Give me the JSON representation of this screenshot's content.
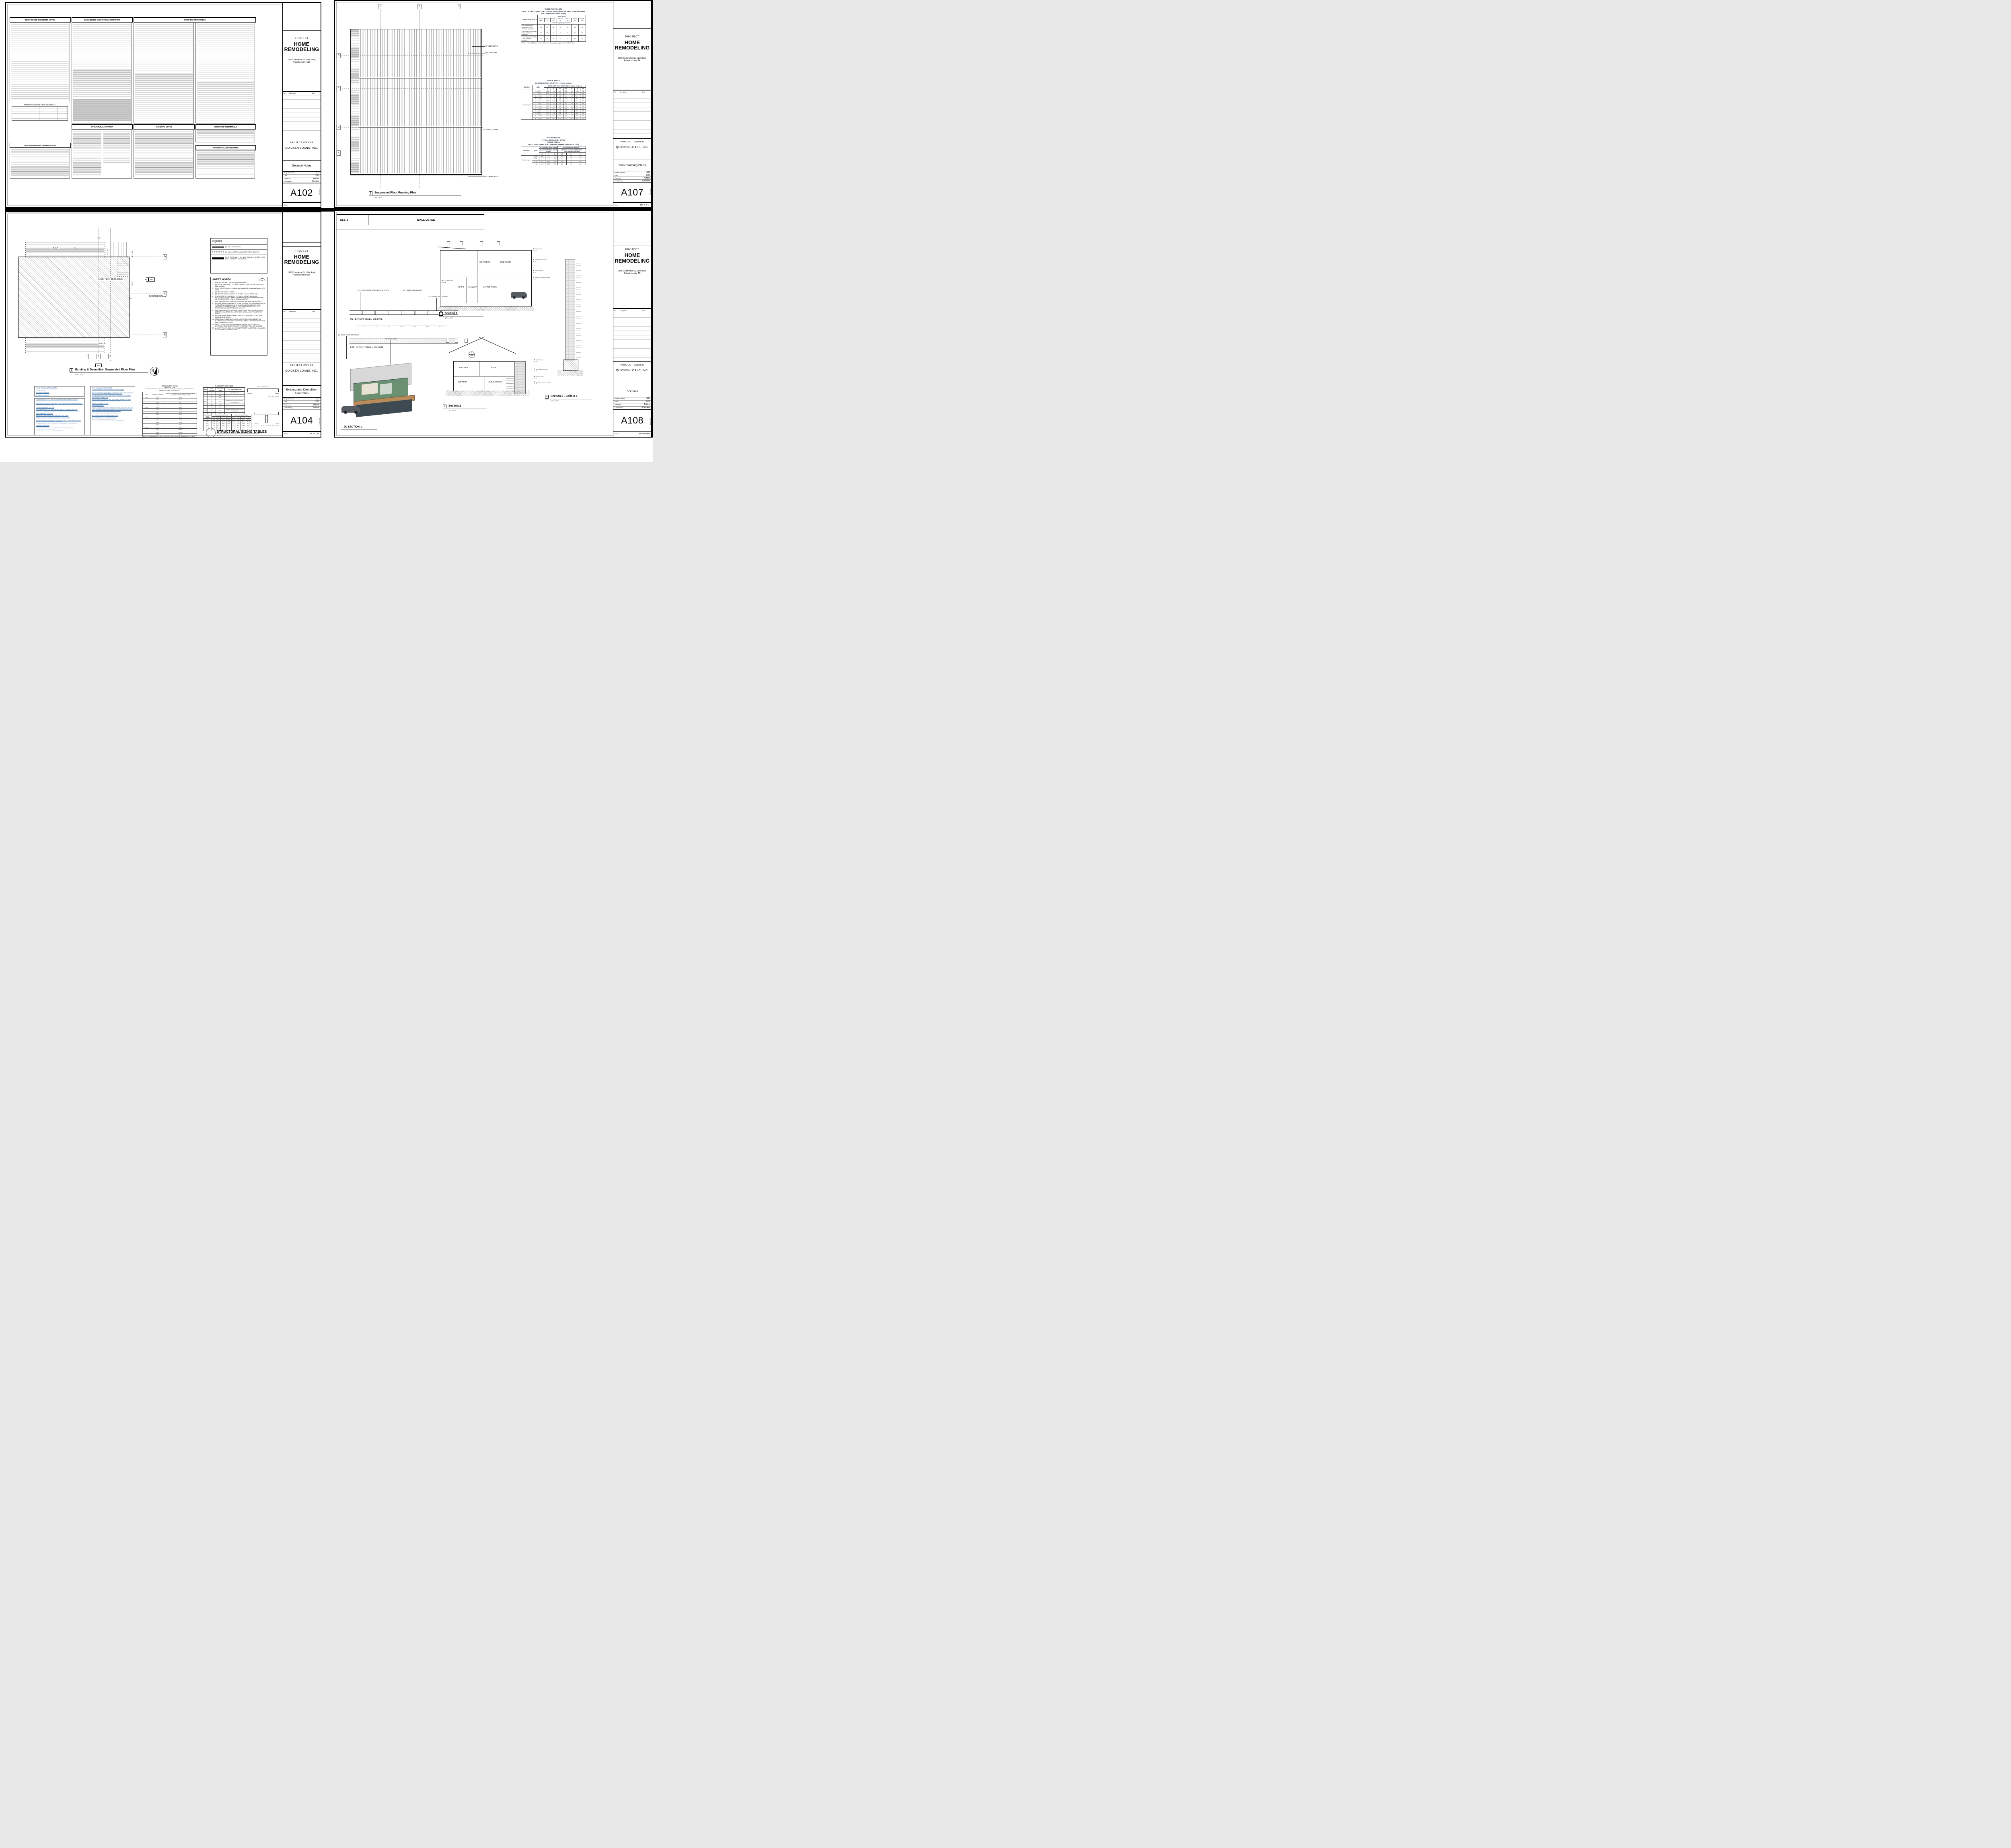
{
  "project": {
    "label": "PROJECT",
    "name": "HOME REMODELING",
    "address": "1506 Commerce St, Little Rock, Pulaski county, AR",
    "owner_label": "PROJECT OWNER",
    "owner": "QUICKEN LOANS, INC.",
    "number": "003",
    "date": "2/22",
    "drawn_by": "Author",
    "checked_by": "Checker",
    "labels": {
      "project_number": "Project number",
      "date": "Date",
      "drawn_by": "Drawn by",
      "checked_by": "Checked by",
      "scale": "Scale"
    },
    "revision": {
      "no": "No.",
      "description": "Description",
      "date": "Date"
    },
    "plot_stamp": "2:48:23 AM"
  },
  "sheets": {
    "a102": {
      "number": "A102",
      "title": "General Notes",
      "scale": "",
      "headers": {
        "col1": "REINFORCED CONCRETE NOTES",
        "col2": "ENGINEERED WOOD TRUSSES/RAFTER",
        "col3": "WOOD FRAMING NOTES",
        "structural": "STRUCTURAL CRITERIA",
        "general": "GENERAL NOTES",
        "deferred": "DEFERRED SUBMITTALS",
        "site": "SITE DRAINAGE RECOMMENDATIONS",
        "anchors": "POST INSTALLED ANCHORS",
        "lap_schedule": "REINFORCED CONCRETE LAP SPLICE SCHEDULE"
      }
    },
    "a107": {
      "number": "A107",
      "title": "Floor Framing Plans",
      "scale": "3/8\" = 1'-0\"",
      "plan": {
        "viewport_no": "1",
        "title": "Suspended Floor Framing Plan",
        "scale": "3/8\" = 1'-0\"",
        "ann_blocking": "2 X 6 BLOCKING",
        "ann_beams": "(2) 2 x 6 BEAMS",
        "ann_joists": "2 x 6 DECK JOISTS",
        "ann_rim": "2 x 6 RIM JOIST",
        "grid_cols": [
          "1",
          "2",
          "3"
        ],
        "grid_rows": [
          "D",
          "C",
          "B",
          "A"
        ]
      },
      "table1": {
        "title1": "TABLE R507.9.1.3(1)",
        "title2": "DECK LEDGER CONNECTION TO BAND JOISTᵃ, ᵇ(Deck live load = 40 psf, deck dead load = 10 psf, snow load ≤ 40 psf)",
        "row_label_header": "CONNECTION DETAILS",
        "col_group": "JOIST SPAN",
        "spans": [
          "6' and less",
          "6'1\" to 8'",
          "8'1\" to 10'",
          "10'1\" to 12'",
          "12'1\" to 14'",
          "14'1\" to 16'",
          "16'1\" to 18'"
        ],
        "subheader": "On-center spacing of fasteners",
        "rows": [
          [
            "½-inch diameter lag screw with ½-inch maximum sheathingᶜ, ᵈ",
            "30",
            "23",
            "18",
            "15",
            "13",
            "11",
            "10"
          ],
          [
            "½-inch diameter bolt with ½-inch maximum sheathingᵈ",
            "36",
            "36",
            "34",
            "29",
            "24",
            "21",
            "19"
          ],
          [
            "½-inch diameter bolt with 1-inch maximum sheathingᵉ",
            "36",
            "36",
            "29",
            "24",
            "21",
            "18",
            "16"
          ]
        ],
        "note": "For SI: 1 inch = 25.4 mm, 1 foot = 304.8 mm, 1 pound per square foot = 0.0479 kPa."
      },
      "table2": {
        "title1": "TABLE R507.5",
        "title2": "DECK BEAM SPAN LENGTHSᵃ, ᵇ, ᵍ (feet - inches)",
        "species_header": "SPECIESᶜ",
        "size_header": "SIZEᵈ",
        "col_group": "DECK JOIST SPAN LESS THAN OR EQUAL TO: (feet)",
        "spans": [
          "6",
          "8",
          "10",
          "12",
          "14",
          "16",
          "18"
        ],
        "species": "Southern pine",
        "rows": [
          [
            "1 — 2 × 6",
            "4-11",
            "4-0",
            "3-7",
            "3-3",
            "3-0",
            "2-10",
            "2-8"
          ],
          [
            "1 — 2 × 8",
            "5-11",
            "5-1",
            "4-7",
            "4-2",
            "2-10",
            "3-7",
            "3-5"
          ],
          [
            "1 — 2 × 10",
            "7-0",
            "6-0",
            "5-5",
            "4-11",
            "4-7",
            "4-3",
            "4-0"
          ],
          [
            "1 — 2 × 12",
            "8-3",
            "7-1",
            "6-4",
            "5-10",
            "5-5",
            "5-0",
            "4-9"
          ],
          [
            "2 — 2 × 6",
            "6-11",
            "5-11",
            "5-4",
            "4-10",
            "4-6",
            "4-3",
            "4-0"
          ],
          [
            "2 — 2 × 8",
            "8-9",
            "7-7",
            "6-9",
            "6-2",
            "5-9",
            "5-4",
            "5-0"
          ],
          [
            "2 — 2 × 10",
            "10-4",
            "9-0",
            "8-0",
            "7-4",
            "6-9",
            "6-4",
            "6-0"
          ],
          [
            "2 — 2 × 12",
            "12-2",
            "10-7",
            "9-5",
            "8-7",
            "8-0",
            "7-6",
            "7-0"
          ],
          [
            "3 — 2 × 6",
            "8-2",
            "7-5",
            "6-8",
            "6-1",
            "5-8",
            "5-3",
            "5-0"
          ],
          [
            "3 — 2 × 8",
            "10-10",
            "9-6",
            "8-6",
            "7-9",
            "7-2",
            "6-8",
            "6-4"
          ],
          [
            "3 — 2 × 10",
            "13-0",
            "11-3",
            "10-0",
            "9-2",
            "8-6",
            "7-11",
            "7-6"
          ],
          [
            "3 — 2 × 12",
            "15-3",
            "13-3",
            "11-10",
            "10-9",
            "10-0",
            "9-4",
            "8-10"
          ]
        ]
      },
      "table3": {
        "title1": "FIGURE R507.6",
        "title2": "TYPICAL DECK JOIST SPANS",
        "title3": "TABLE R507.6",
        "title4": "DECK JOIST SPANS FOR COMMON LUMBER SPECIES (ft. - in.)",
        "species_header": "SPECIESᵃ",
        "size_header": "SIZE",
        "group1": "ALLOWABLE JOIST SPANᵇ",
        "group1_sub": "SPACING OF DECK JOISTS (inches)",
        "group2": "MAXIMUM CANTILEVERᶜ, ᶠ",
        "group2_sub": "SPACING OF DECK JOISTS WITH CANTILEVERSᶜ (inches)",
        "spacings": [
          "12",
          "16",
          "24",
          "12",
          "16",
          "24"
        ],
        "species": "Southern pine",
        "rows": [
          [
            "2 × 6",
            "9-11",
            "9-0",
            "7-7",
            "1-3",
            "1-4",
            "1-6"
          ],
          [
            "2 × 8",
            "13-1",
            "11-10",
            "9-8",
            "2-1",
            "2-3",
            "2-5"
          ],
          [
            "2 × 10",
            "16-2",
            "14-0",
            "11-5",
            "3-4",
            "3-6",
            "2-10"
          ],
          [
            "2 × 12",
            "18-0",
            "16-6",
            "13-6",
            "4-6",
            "4-2",
            "3-4"
          ]
        ]
      }
    },
    "a104": {
      "number": "A104",
      "title": "Existing and Demolition Floor Plan",
      "scale": "1/4\" = 1'-0\"",
      "legend": {
        "title": "legend",
        "items": [
          {
            "label": "(E) WALL TO REMAIN"
          },
          {
            "label": "(E) WALL, DOORS AND WINDOWS TO REMOVE"
          },
          {
            "label": "(N) 2x STUD WALL - ALL NEW WALLS TO RECEIVE 2X6 WITH R-13 BATT. INSULATION"
          }
        ]
      },
      "sheet_notes": {
        "title": "SHEET NOTES",
        "badge": "##",
        "items": [
          "REMOVE THIS WALL OPENING (SHOWN DASHED).",
          "(N) 4x10 HEADER WITH 2 -2x CRIPPLE WOOD STUDS AT EACH END OF THE NEW HEADER.",
          "(N) LG - 24k BTU Cooling + Heating - Wall Mounted Air Conditioning System - 17.0 SEER",
          "(N) PROVIDE WATER HEATER",
          "(N) PROVIDE WATER CLOSETS TO BE MAX. 1.28 GAL. PER FLUSH.",
          "SHOWER/TUB W/ FULL HEIGHT TILE WALLS & TEMPERED GLASS ENCLOSURE. USE BITUTHANE 4,000 WATERPROOFING MEMBRANE OVER 1/2\" WONDER BOARD & WALLS, CEILING, & FLOOR.",
          "NEW SOLID SURFACE (NON-SLIP RESISTANT) SHOWER PAN AND WALLS.",
          "PROVIDE SHOWER FINISHED TO 72\" ABOVE DRAIN. PROVIDE PRESSURE OR THERMOSTATIC MIXING VALUE @ SHOWER AND JACUZZI/TUB, WHICH LIMITS WATER TEMPERATURE TO 120°F. SHOWER HEAD SHALL NOT EXCEED 1.8 GALLONS PER MINUTE AT 60 PSI.",
          "NEW SINK AND FAUCET. PROVIDE FAUCET TO BE MAX 1.2 CMP AT 60 PSI. METERING FAUCETS SHALL NOT EXCEED 0.2 GALLONS PER METERING CYCLE.",
          "PROVIDE WATER HAMMER ARRESTORS AT ALL APPLIANCES THAT HAVE QUICK-ACTING VALVES",
          "REMOVE ALL PLUMBING FIXTURES, ACCESSORIES, AND CABINET. CAP PLUMBING LINS TEMPORARY FOR NEW PLUMBING LINES TEMPORARY FOR NEW PLUMBING FIXTURES.",
          "SAFETY GLASS TO BE USED WITHIN 3ft OF DOOR ENTRY LOCKS, AT ENNTRANCE DOORS AND SIDELIGHTS, NEAR BATHTUBS AND JACUZZIS.",
          "ALL SOFFITS LESS THAN 3.94 ft FROM PROPERTY LINES TO BE NON-VENTED SOLID MATERIAL CONSTRUCTION"
        ]
      },
      "plan": {
        "viewport_no": "1",
        "title": "Existing & Demolition Suspended Floor Plan",
        "scale": "1/4\" = 1'-0\"",
        "deck_top": "DECK",
        "deck_bottom": "DECK",
        "building": "EXISTING BUILDING",
        "walls": "EXISTING WALLS",
        "dn": "DN",
        "north": "N",
        "grid_cols": [
          "1",
          "2",
          "3"
        ],
        "grid_rows": [
          "D",
          "C",
          "B"
        ],
        "dim1": "7' - 4\"",
        "dim2": "6' - 6 1/2\"",
        "dim3": "12' - 2 1/2\"",
        "dim4": "30' - 6\"",
        "callout": {
          "no": "4",
          "sheet": "A109"
        },
        "section_marker": {
          "no": "1",
          "sheet": "A110"
        }
      },
      "floor_notes_header": {
        "title": "FLOOR FRAMING & TRUSS NOTES:",
        "items": [
          "FLOOR: 30 PSF LL",
          "10 PSF TOP CHORD DL",
          "5 PSF BOT. CHORD DL"
        ]
      },
      "floor_notes": [
        "FLOORS 3 AND 2 SHALL HAVE 22\" FLOOR TRUSSES; BOTTOM FLOOR IS CONCRETE SLAB.",
        "SUB-FLOOR SHEATHING SHALL BE H 1.125\". SHEATHING IS REQUIRED FOR ANY LONGITUDINAL(DRAG) FORCES.",
        "TRUSSES SPACED AT 24.0\" O/C.",
        "TRUSS DRAWING IS FOR ILLUSTRATION ONLY. ALL TRUSSES SHALL BE INSTALLED & BRACED TO MANUFACTURERS DRAWINGS & SPECIFICATIONS.",
        "ALL PLATES ARE 1.5 X 4 UNO",
        "DEFLECTION MEETS L/480 LIVE AND L/360 TOTAL LOAD.",
        "FASTEN RATED SHEATHING TO ONE FACE OF THIS FRAME.",
        "ALL TRUSSES WILL NOT BE FIELD ALTERED WITHOUT PRIOR BUILDING DEPT. APPROVAL OF ENGINEERING CALCULATIONS.",
        "ALL TRUSSES SHALL HAVE DESIGN DETAILS & DRAWINGS ON SITE FOR FRAMING INSPECTION.",
        "ALL FLOOR TRUSSES SHALL CARRY MANUFACTURERS STAMP.",
        "FLOOR TRUSS MANUFACTURER: ___________"
      ],
      "roof_notes_title": "ROOF FRAMING / TRUSS NOTES:",
      "roof_notes": [
        "ALL TRUSSES SHALL CARRY MANUFACTURERS STAMP.",
        "ALL TRUSSES WILL NOT BE FIELD ALTERED WITHOUT PRIOR BUILDING DEPT. APPROVAL OF ENGINEERING CALCULATIONS.",
        "ALL TRUSSES SHALL HAVE DESIGN DETAILS & DRAWINGS ON SITE FOR FRAMING INSPECTION.",
        "ALL CONNECTIONS OF RAFTERS, JACK OR HIP TRUSSES TO MAIN GIRDER PROVIDED BY TRUSS MANUFACTURER.",
        "ALL ROOF FRAMING 24\" O.C.",
        "ALL OVERHANGS 16\".",
        "INSTALL POLYISOCYANURATE FOAM TYPE INSULATION AT FLOOR AND PLATE OPENINGS IN PLATES, CORNER STUD CAVITIES AND AROUND DOOR AND WINDOW ROUGH OPENING CAVITIES.",
        "ATTIC VENTILATION: REQUIRED ABOVE HOUSE.",
        "MIN. SNOW LOAD 50 LBs PER SQUARE FOOT.",
        "WALL HEADERS: (2) 2 X 10 DF 2 TYP. UNO",
        "ROOF & FLOOR TRUSS MANUFACTURER: ___________"
      ],
      "ceiling_table": {
        "title": "CEILING JOIST SPANS",
        "note1": "DEAD LOAD = 5psf",
        "note2": "***IF HABITABLE ATTIC SPACE OF STORAGE IS DESIRED, REFER TO THE INTERNATIONAL RESIDENTIAL CODE, SPAN TABLES.***",
        "headers": [
          "SIZE",
          "SPACING (INCHES)",
          "VISUALLY GRADED #2 SOUTHERN PINE (MAXIMUM CEILING JOIST SPANS) (FT. - IN.)"
        ],
        "rows": [
          [
            "2 x 4",
            "12.0",
            "12-5"
          ],
          [
            "",
            "16.0",
            "11-3"
          ],
          [
            "",
            "19.2",
            "10-7"
          ],
          [
            "",
            "24.0",
            "9-10"
          ],
          [
            "2 x 6",
            "12.0",
            "19-6"
          ],
          [
            "",
            "16.0",
            "17-8"
          ],
          [
            "",
            "19.2",
            "16-8"
          ],
          [
            "",
            "24.0",
            "15-6"
          ],
          [
            "2 x 8",
            "12.0",
            "25-8"
          ],
          [
            "",
            "16.0",
            "23-4"
          ],
          [
            "",
            "19.2",
            "21-11"
          ],
          [
            "",
            "24.0",
            "20-1"
          ],
          [
            "2 x 10",
            "12.0",
            "XXXXX"
          ],
          [
            "",
            "16.0",
            "XXXXX"
          ],
          [
            "",
            "19.2",
            "XXXXX"
          ],
          [
            "",
            "24.0",
            "23-11"
          ]
        ],
        "notes_title": "NOTES:",
        "notes": "For additional species, grades, and notes, refer to the International Residential Code. The above tables are based on the 2003 edtion, table R802.4(1)."
      },
      "floor_joist_table": {
        "title": "FLOOR JOIST SPAN TABLE",
        "headers": [
          "SIZE",
          "JOIST SPACING",
          "MAX. JOIST SPAN",
          "MAX. JOIST CANTILEVER"
        ],
        "rows": [
          [
            "2\"x6\"",
            "12\"",
            "10'-4\"",
            "NOT PERMITTED"
          ],
          [
            "",
            "16\"",
            "9'-4\"",
            ""
          ],
          [
            "",
            "24\"",
            "8'-2\"",
            ""
          ],
          [
            "2\"x8\"",
            "12\"",
            "12'-5\"",
            "LESSER OF 16\" OR 1/7 OF TOTAL JOIST LENGTH"
          ],
          [
            "",
            "16\"",
            "11'-9\"",
            ""
          ],
          [
            "",
            "24\"",
            "10'-9\"",
            ""
          ],
          [
            "2\"x10\"",
            "12\"",
            "14'-6\"",
            "LESSER OF 24\" OR 1/7 OF TOTAL JOIST LENGTH"
          ],
          [
            "",
            "16\"",
            "13'-9\"",
            ""
          ],
          [
            "",
            "24\"",
            "12'-10\"",
            ""
          ],
          [
            "2\"x12\"",
            "12\"",
            "16'-4\"",
            ""
          ],
          [
            "",
            "16\"",
            "15'-5\"",
            ""
          ],
          [
            "",
            "24\"",
            "14'-6\"",
            ""
          ]
        ]
      },
      "beam_table": {
        "title": "BEAM SPAN TABLE",
        "col1": "SUPPORTED JOIST LENGTH",
        "group1": "MAX. 2-PLY BEAM SPAN",
        "group2": "MAX. 3-PLY BEAM SPAN",
        "sizes": [
          "2\"x6\"",
          "2\"x8\"",
          "2\"x10\"",
          "2\"x12\"",
          "2\"x6\"",
          "2\"x8\"",
          "2\"x10\"",
          "2\"x12\""
        ],
        "rows": [
          [
            "4'-0\"",
            "8'-0\"",
            "10'-4\"",
            "12'-7\"",
            "14'-7\"",
            "9'-7\"",
            "12'-7\"",
            "16'-1\"",
            "19'-7\""
          ],
          [
            "6'-0\"",
            "6'-10\"",
            "8'-4\"",
            "10'-4\"",
            "11'-9\"",
            "8'-4\"",
            "11'-0\"",
            "14'-1\"",
            "17'-1\""
          ],
          [
            "8'-0\"",
            "5'-11\"",
            "7'-2\"",
            "8'-10\"",
            "10'-3\"",
            "7'-7\"",
            "10'-0\"",
            "11'-10\"",
            "14'-1\""
          ],
          [
            "10'-0\"",
            "5'-3\"",
            "6'-5\"",
            "7'-10\"",
            "9'-2\"",
            "7'-1\"",
            "9'-4\"",
            "10'-10\"",
            "12'-7\""
          ],
          [
            "12'-0\"",
            "4'-10\"",
            "5'-11\"",
            "7'-2\"",
            "8'-4\"",
            "6'-8\"",
            "8'-7\"",
            "9'-11\"",
            "11'-6\""
          ],
          [
            "14'-0\"",
            "4'-6\"",
            "5'-5\"",
            "6'-8\"",
            "7'-9\"",
            "6'-4\"",
            "7'-11\"",
            "9'-2\"",
            "10'-8\""
          ]
        ]
      },
      "diagram_labels": {
        "total": "TOTAL JOIST LENGTH",
        "ledger": "LEDGER",
        "beam": "BEAM",
        "joist_cant": "JOIST CANTILEVER",
        "beam2": "BEAM",
        "post": "POST",
        "max_cant": "MAX. 1' - 0\" BEAM CANTILEVER"
      },
      "sizing_title": {
        "title": "STRUCTURAL SIZING TABLES",
        "scale": "N.T.S."
      }
    },
    "a108": {
      "number": "A108",
      "title": "Sections",
      "scale": "As indicated",
      "det_header": {
        "left": "DET. 3",
        "right": "WALL DETAIL"
      },
      "wall_details": {
        "stud_label": "2\" x 4\" SOFTWOOD STUD WORK @ 16\" O.C",
        "board_label_1": "1/2\" TIMBER WALL BOARD",
        "board_label_2": "1/2\" TIMBER WALL BOARD",
        "interior": "INTERIOR WALL DETAIL",
        "exterior": "EXTERIOR WALL DETAIL",
        "dim": "1' - 4\""
      },
      "section1": {
        "viewport_no": "1",
        "title": "Section 1",
        "scale": "1/4\" = 1'-0\"",
        "room_deck": "(N) COVERED DECK",
        "room_bath": "BATH",
        "room_hall": "HALLWAY",
        "room_living": "LIVING ROOM",
        "room_corridor": "CORRIDOR",
        "room_bedroom": "BEDROOM"
      },
      "section2": {
        "viewport_no": "2",
        "title": "Section 2",
        "scale": "1/4\" = 1'-0\"",
        "room_kitchen": "KITCHEN",
        "room_bath": "BATH",
        "room_wetbar": "WETBAR",
        "room_living": "LIVING ROOM",
        "dim": "8' - 4\"",
        "callout": {
          "no": "4",
          "sheet": "A108"
        }
      },
      "callout1": {
        "viewport_no": "4",
        "title": "Section 2 - Callout 1",
        "scale": "3/4\" = 1'-0\""
      },
      "levels": [
        {
          "name": "ROOF LEVEL",
          "elev": "18' - 0\""
        },
        {
          "name": "SUSPENDED FLOOR",
          "elev": "9' - 0\""
        },
        {
          "name": "FIRST FLOOR",
          "elev": "0' - 6\""
        },
        {
          "name": "NATURAL GROUND LEVEL",
          "elev": "0' - 0\""
        }
      ],
      "labels": {
        "deck_retained": "(E) DECK TO BE RETAINED",
        "existing_roof": "EXISTING ROOF",
        "view3d": "3D SECTION_1"
      },
      "colors": {
        "wall_green": "#6b8f71",
        "dark_frame": "#3d4a52",
        "wood": "#b98a5a",
        "roof_gray": "#d8d8d8",
        "car_gray": "#555b61"
      }
    }
  }
}
